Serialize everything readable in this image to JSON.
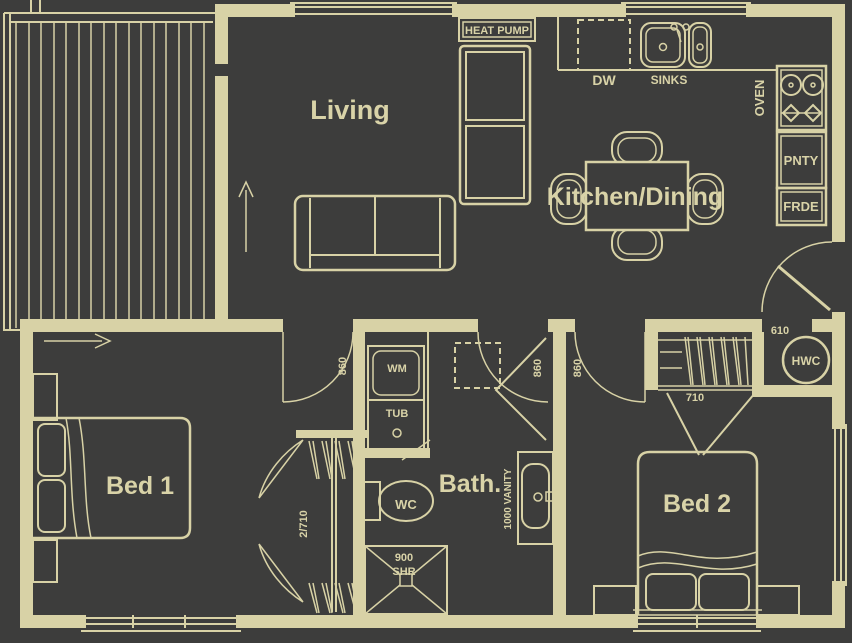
{
  "plan": {
    "background": "#3d3d3c",
    "line_color": "#d8d2a6",
    "rooms": {
      "living": "Living",
      "kitchen_dining": "Kitchen/Dining",
      "bed1": "Bed 1",
      "bed2": "Bed 2",
      "bath": "Bath."
    },
    "fixtures": {
      "heat_pump": "HEAT PUMP",
      "dishwasher": "DW",
      "sinks": "SINKS",
      "oven": "OVEN",
      "pantry": "PNTY",
      "fridge": "FRDE",
      "washing_machine": "WM",
      "laundry_tub": "TUB",
      "toilet": "WC",
      "shower_width": "900",
      "shower": "SHR",
      "vanity": "1000 VANITY",
      "hot_water": "HWC"
    },
    "dimensions": {
      "bed1_door": "860",
      "bath_door": "860",
      "bed2_door": "860",
      "kitchen_hall_opening": "610",
      "linen_door": "710",
      "wardrobe_doors": "2/710"
    }
  }
}
